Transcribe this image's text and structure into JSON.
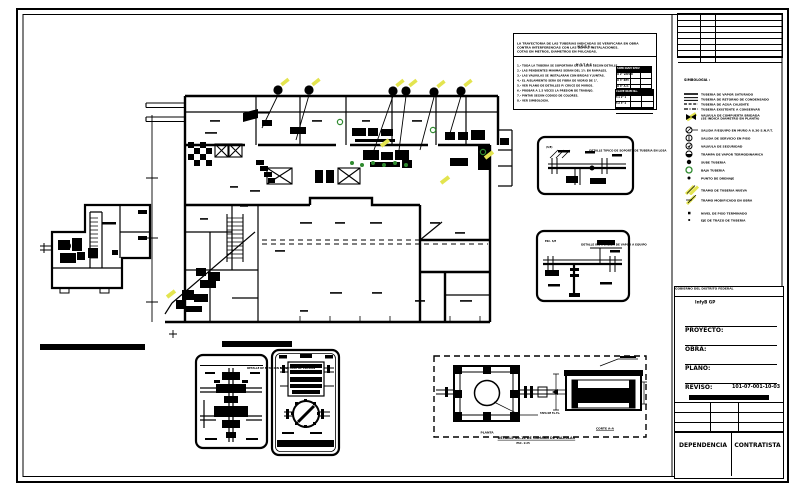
{
  "revision_table": {
    "headers": [
      "FECHA",
      "REV.",
      "D E S C R I P C I O N"
    ]
  },
  "legend": {
    "title": "SIMBOLOGIA :",
    "items": [
      {
        "symbol": "line-solid",
        "label": "TUBERIA DE VAPOR SATURADO"
      },
      {
        "symbol": "line-double",
        "label": "TUBERIA DE RETORNO DE CONDENSADO"
      },
      {
        "symbol": "line-dashed",
        "label": "TUBERIA DE AGUA CALIENTE"
      },
      {
        "symbol": "line-dashdot",
        "label": "TUBERIA EXISTENTE A CONSERVAR"
      },
      {
        "symbol": "valve-highlight",
        "label": "VALVULA DE COMPUERTA BRIDADA",
        "label2": "(SE INDICA DIAMETRO EN PLANTA)"
      },
      {
        "symbol": "circle-slash",
        "label": "SALIDA P/EQUIPO EN MURO A 0.30 S.N.P.T."
      },
      {
        "symbol": "circle-bar",
        "label": "SALIDA DE SERVICIO EN PISO"
      },
      {
        "symbol": "circle-check",
        "label": "VALVULA DE SEGURIDAD"
      },
      {
        "symbol": "circle-half",
        "label": "TRAMPA DE VAPOR TERMODINAMICA"
      },
      {
        "symbol": "dot",
        "label": "SUBE TUBERIA"
      },
      {
        "symbol": "circle-green",
        "label": "BAJA TUBERIA"
      },
      {
        "symbol": "dot-small",
        "label": "PUNTO DE DRENAJE"
      },
      {
        "symbol": "hatch-yellow",
        "label": "TRAMO DE TUBERIA NUEVA"
      },
      {
        "symbol": "hatch-yellow2",
        "label": "TRAMO MODIFICADO EN OBRA"
      },
      {
        "symbol": "square-tick",
        "label": "NIVEL DE PISO TERMINADO"
      },
      {
        "symbol": "square-small",
        "label": "EJE DE TRAZO DE TUBERIA"
      }
    ]
  },
  "notes": {
    "heading1": "N O T A :",
    "para1": "LA TRAYECTORIA DE LAS TUBERIAS INDICADAS SE VERIFICARA EN OBRA",
    "para2": "CONTRA INTERFERENCIAS CON LAS DEMAS INSTALACIONES.",
    "para3": "COTAS EN METROS, DIAMETROS EN PULGADAS.",
    "heading2": "N O T A S :",
    "items": [
      "1.- TODA LA TUBERIA SE SOPORTARA DE LA LOSA SEGUN DETALLE.",
      "2.- LAS PENDIENTES MINIMAS SERAN DEL 1% EN RAMALES.",
      "3.- LAS VALVULAS SE INSTALARAN CON BRIDAS Y JUNTAS.",
      "4.- EL AISLAMIENTO SERA DE FIBRA DE VIDRIO DE 1\".",
      "5.- VER PLANO DE DETALLES P/ CRUCE DE MUROS.",
      "6.- PROBAR A 1.5 VECES LA PRESION DE TRABAJO.",
      "7.- PINTAR SEGUN CODIGO DE COLORES.",
      "8.- VER SIMBOLOGIA."
    ],
    "table1_rows": [
      "SIMB DIAM SERV",
      "O  2\"  VAPOR",
      "O  3\"  RET.",
      "O  4\"  A.C."
    ],
    "table2_rows": [
      "CLAVE  DIAM  No.",
      "T-1  2\"  1",
      "T-2  3\"  2",
      "T-3  4\"  1"
    ]
  },
  "details": {
    "a": {
      "title": "DETALLE TIPICO DE SOPORTE DE TUBERIA EN LOSA",
      "sub": "(S/E)"
    },
    "b": {
      "title": "DETALLE INST. SALIDA DE VAPOR A EQUIPO",
      "sub": "ESC. S/E"
    },
    "c": {
      "title": "DETALLE DE ESTACION REDUCTORA DE PRESION"
    },
    "d": {
      "footer": "DETALLE DE TRAMPA DE VAPOR"
    },
    "chamber": {
      "plan_label": "PLANTA",
      "leader_label": "TAPA DE Fo.Fo.",
      "title": "DETALLE No.14 DE CAMARA DE VALVULAS",
      "subtitle": "ESC. 1:25",
      "section_label": "CORTE A-A"
    }
  },
  "title_block": {
    "header_left": "GOBIERNO DEL DISTRITO FEDERAL",
    "header_right": "D.G.C.O.H.",
    "logo": "InfyB GP",
    "field1": "PROYECTO:",
    "field2": "OBRA:",
    "field3": "PLANO:",
    "field4": "REVISO:",
    "drawing_no": "101-07-001-10-03",
    "band": "RED DE DISTRIBUCION DE VAPOR",
    "grid": {
      "r1c1": "ESCALA",
      "r1c2": "1:100",
      "r1c3": "ACOT: m  //",
      "r2c1": "DIBUJO  //",
      "r2c2": "FECHA",
      "r2c3": "OCT-94  //",
      "r3c1": "//  REV.",
      "r3c2": "0",
      "r3c3": "//  HOJA 1/1"
    },
    "cell_left": "DEPENDENCIA",
    "cell_right": "CONTRATISTA"
  },
  "colors": {
    "line": "#000000",
    "highlight_yellow": "#e3e44f",
    "highlight_green": "#2f8a2f",
    "paper": "#ffffff"
  }
}
